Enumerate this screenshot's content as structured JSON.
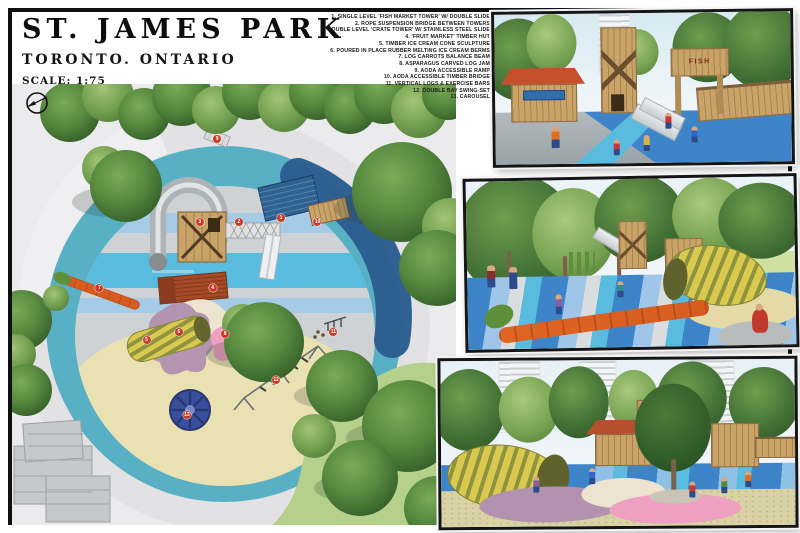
{
  "board": {
    "title": "ST. JAMES PARK",
    "subtitle": "TORONTO. ONTARIO",
    "scale_label": "SCALE: 1:75"
  },
  "legend": {
    "items": [
      "1. SINGLE LEVEL 'FISH MARKET TOWER' W/ DOUBLE SLIDE",
      "2. ROPE SUSPENSION BRIDGE BETWEEN TOWERS",
      "3. DOUBLE LEVEL 'CRATE TOWER' W/ STAINLESS STEEL SLIDE",
      "4. 'FRUIT MARKET' TIMBER HUT",
      "5. TIMBER ICE CREAM CONE SCULPTURE",
      "6. POURED IN PLACE RUBBER MELTING ICE CREAM BERMS",
      "7. LOG CARROTS BALANCE BEAM",
      "8. ASPARAGUS CARVED LOG JAM",
      "9. AODA ACCESSIBLE RAMP",
      "10. AODA ACCESSIBLE TIMBER BRIDGE",
      "11. VERTICAL LOGS & EXERCISE BARS",
      "12. DOUBLE BAY SWING-SET",
      "13. CAROUSEL"
    ]
  },
  "plan": {
    "markers": [
      {
        "n": "1",
        "x": 60.6,
        "y": 30.4
      },
      {
        "n": "2",
        "x": 51.1,
        "y": 31.3
      },
      {
        "n": "3",
        "x": 42.3,
        "y": 31.3
      },
      {
        "n": "4",
        "x": 45.2,
        "y": 46.3
      },
      {
        "n": "5",
        "x": 30.3,
        "y": 58.1
      },
      {
        "n": "6",
        "x": 37.6,
        "y": 56.2
      },
      {
        "n": "7",
        "x": 19.7,
        "y": 46.3
      },
      {
        "n": "8",
        "x": 48.0,
        "y": 56.7
      },
      {
        "n": "9",
        "x": 46.2,
        "y": 12.4
      },
      {
        "n": "10",
        "x": 68.8,
        "y": 31.3
      },
      {
        "n": "11",
        "x": 72.4,
        "y": 56.2
      },
      {
        "n": "12",
        "x": 59.5,
        "y": 67.1
      },
      {
        "n": "13",
        "x": 39.4,
        "y": 75.1
      }
    ]
  },
  "renders": [
    {
      "label": "fish-market-towers-perspective",
      "sign_text": "FISH"
    },
    {
      "label": "carrot-balance-beam-perspective"
    },
    {
      "label": "melting-ice-cream-berms-perspective"
    }
  ],
  "colors": {
    "frame-black": "#101010",
    "marker-red": "#cc3b25",
    "water-teal": "#58b0c4",
    "water-cyan": "#59bcdf",
    "stripe-blue": "#a6cbe7",
    "rubber-gray": "#cfd2d5",
    "deep-blue": "#2b5d8f",
    "sand": "#eae1b2",
    "grass": "#b4d08a",
    "tree-green": "#4c7a38",
    "wood-tan": "#c9a368",
    "roof-red": "#a84a28",
    "carrot-orange": "#d85c1f",
    "cone-yellow": "#d9c94e",
    "cone-olive": "#8f9340",
    "berm-purple": "#b292ae",
    "berm-pink": "#ef9fc1",
    "carousel-blue": "#3b4e9e",
    "render-ground-blue": "#3d85c8",
    "sky": "#d7e9f2"
  }
}
